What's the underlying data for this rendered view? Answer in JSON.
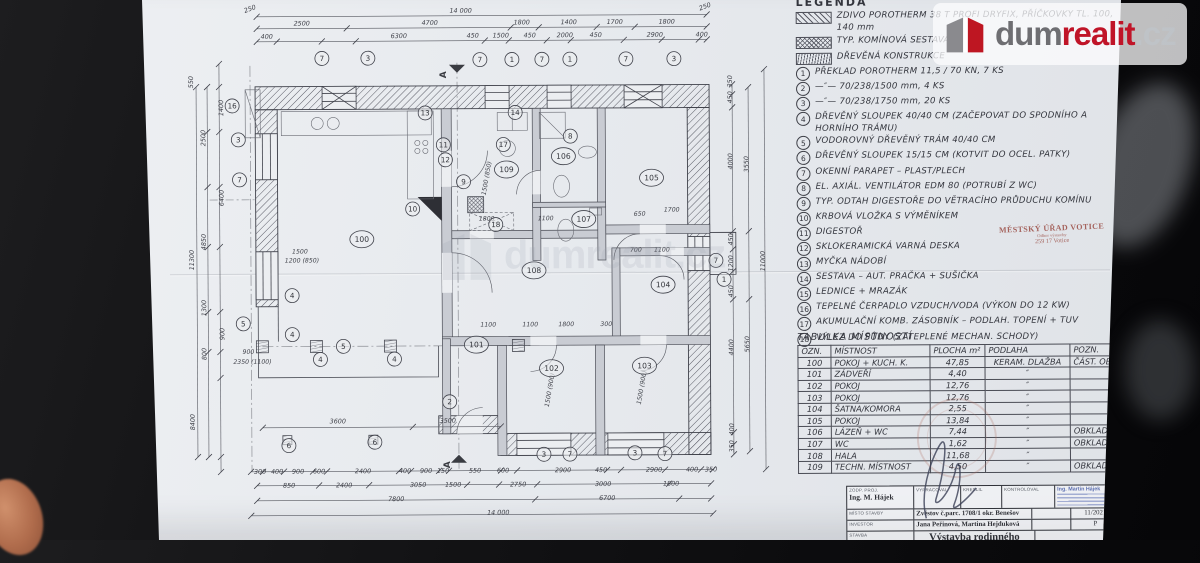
{
  "logo": {
    "dum": "dum",
    "realit": "realit",
    "cz": ".cz"
  },
  "watermark": {
    "dum": "dum",
    "realit": "realit",
    "cz": ".cz"
  },
  "legend": {
    "title": "LEGENDA",
    "swatches": [
      {
        "style": "brick",
        "label": "ZDIVO POROTHERM 38 T PROFI DRYFIX, PŘÍČKOVKY TL. 100, 140 mm"
      },
      {
        "style": "chimney",
        "label": "TYP. KOMÍNOVÁ SESTAVA"
      },
      {
        "style": "wood",
        "label": "DŘEVĚNÁ KONSTRUKCE"
      }
    ],
    "items": [
      {
        "num": "1",
        "text": "PŘEKLAD POROTHERM 11,5 / 70 KN, 7 KS"
      },
      {
        "num": "2",
        "text": "—″— 70/238/1500 mm, 4 KS"
      },
      {
        "num": "3",
        "text": "—″— 70/238/1750 mm, 20 KS"
      },
      {
        "num": "4",
        "text": "DŘEVĚNÝ SLOUPEK 40/40 CM (ZAČEPOVAT DO SPODNÍHO A HORNÍHO TRÁMU)"
      },
      {
        "num": "5",
        "text": "VODOROVNÝ DŘEVĚNÝ TRÁM 40/40 CM"
      },
      {
        "num": "6",
        "text": "DŘEVĚNÝ SLOUPEK 15/15 CM (KOTVIT DO OCEL. PATKY)"
      },
      {
        "num": "7",
        "text": "OKENNÍ PARAPET – PLAST/PLECH"
      },
      {
        "num": "8",
        "text": "EL. AXIÁL. VENTILÁTOR EDM 80 (POTRUBÍ Z WC)"
      },
      {
        "num": "9",
        "text": "TYP. ODTAH DIGESTOŘE DO VĚTRACÍHO PRŮDUCHU KOMÍNU"
      },
      {
        "num": "10",
        "text": "KRBOVÁ VLOŽKA S VÝMĚNÍKEM"
      },
      {
        "num": "11",
        "text": "DIGESTOŘ"
      },
      {
        "num": "12",
        "text": "SKLOKERAMICKÁ VARNÁ DESKA"
      },
      {
        "num": "13",
        "text": "MYČKA NÁDOBÍ"
      },
      {
        "num": "14",
        "text": "SESTAVA – AUT. PRAČKA + SUŠIČKA"
      },
      {
        "num": "15",
        "text": "LEDNICE + MRAZÁK"
      },
      {
        "num": "16",
        "text": "TEPELNÉ ČERPADLO VZDUCH/VODA (VÝKON DO 12 KW)"
      },
      {
        "num": "17",
        "text": "AKUMULAČNÍ KOMB. ZÁSOBNÍK – PODLAH. TOPENÍ + TUV"
      },
      {
        "num": "18",
        "text": "VÝLEZ DO PŮDY (ZATEPLENÉ MECHAN. SCHODY)"
      }
    ]
  },
  "votice_stamp": {
    "line1": "MĚSTSKÝ ÚŘAD VOTICE",
    "line2": "Odbor výstavby",
    "line3": "259 17 Votice"
  },
  "room_table": {
    "title": "TABULKA MÍSTNOSTÍ",
    "headers": [
      "OZN.",
      "MÍSTNOST",
      "PLOCHA m²",
      "PODLAHA",
      "POZN."
    ],
    "rows": [
      [
        "100",
        "POKOJ + KUCH. K.",
        "47,85",
        "KERAM. DLAŽBA",
        "ČÁST. OBKLAD"
      ],
      [
        "101",
        "ZÁDVEŘÍ",
        "4,40",
        "″",
        ""
      ],
      [
        "102",
        "POKOJ",
        "12,76",
        "″",
        ""
      ],
      [
        "103",
        "POKOJ",
        "12,76",
        "″",
        ""
      ],
      [
        "104",
        "ŠATNA/KOMORA",
        "2,55",
        "″",
        ""
      ],
      [
        "105",
        "POKOJ",
        "13,84",
        "″",
        ""
      ],
      [
        "106",
        "LÁZEŇ + WC",
        "7,44",
        "″",
        "OBKLAD"
      ],
      [
        "107",
        "WC",
        "1,62",
        "″",
        "OBKLAD"
      ],
      [
        "108",
        "HALA",
        "11,68",
        "″",
        ""
      ],
      [
        "109",
        "TECHN. MÍSTNOST",
        "4,50",
        "″",
        "OBKLAD"
      ]
    ]
  },
  "title_block": {
    "resp_label": "ZODP. PROJ.",
    "resp_value": "Ing. M. Hájek",
    "drafted_label": "VYPRACOVAL",
    "drawn_label": "KRESLIL",
    "checked_label": "KONTROLOVAL",
    "site_label": "MÍSTO STAVBY",
    "site_value": "Zvěstov č.parc. 1708/1 okr. Benešov",
    "investor_label": "INVESTOR",
    "investor_value": "Jana Peřinová, Martina Hejduková",
    "project_label": "STAVBA",
    "project_value": "Výstavba rodinného domku",
    "date_value": "11/2021",
    "stage_value": "P",
    "stamp_name": "Ing. Martin Hájek"
  },
  "plan": {
    "dims": [
      {
        "t": "14 000",
        "x": 462,
        "y": 12
      },
      {
        "t": "250",
        "x": 252,
        "y": 9,
        "r": -20
      },
      {
        "t": "250",
        "x": 707,
        "y": 9,
        "r": -20
      },
      {
        "t": "2500",
        "x": 303,
        "y": 24
      },
      {
        "t": "4700",
        "x": 431,
        "y": 24
      },
      {
        "t": "1800",
        "x": 523,
        "y": 24
      },
      {
        "t": "1400",
        "x": 570,
        "y": 24
      },
      {
        "t": "1700",
        "x": 616,
        "y": 24
      },
      {
        "t": "1800",
        "x": 668,
        "y": 24
      },
      {
        "t": "400",
        "x": 268,
        "y": 37
      },
      {
        "t": "6300",
        "x": 400,
        "y": 37
      },
      {
        "t": "450",
        "x": 474,
        "y": 37
      },
      {
        "t": "1500",
        "x": 502,
        "y": 37
      },
      {
        "t": "450",
        "x": 531,
        "y": 37
      },
      {
        "t": "2000",
        "x": 566,
        "y": 37
      },
      {
        "t": "450",
        "x": 597,
        "y": 37
      },
      {
        "t": "2900",
        "x": 656,
        "y": 37
      },
      {
        "t": "400",
        "x": 703,
        "y": 37
      },
      {
        "t": "300",
        "x": 259,
        "y": 472
      },
      {
        "t": "400",
        "x": 276,
        "y": 472
      },
      {
        "t": "900",
        "x": 297,
        "y": 472
      },
      {
        "t": "600",
        "x": 318,
        "y": 472
      },
      {
        "t": "2400",
        "x": 362,
        "y": 472
      },
      {
        "t": "400",
        "x": 404,
        "y": 472
      },
      {
        "t": "900",
        "x": 425,
        "y": 472
      },
      {
        "t": "150",
        "x": 442,
        "y": 472
      },
      {
        "t": "550",
        "x": 474,
        "y": 472
      },
      {
        "t": "600",
        "x": 502,
        "y": 472
      },
      {
        "t": "2900",
        "x": 562,
        "y": 472
      },
      {
        "t": "450",
        "x": 600,
        "y": 472
      },
      {
        "t": "2900",
        "x": 653,
        "y": 472
      },
      {
        "t": "400",
        "x": 691,
        "y": 472
      },
      {
        "t": "350",
        "x": 710,
        "y": 472
      },
      {
        "t": "850",
        "x": 288,
        "y": 486
      },
      {
        "t": "2400",
        "x": 343,
        "y": 486
      },
      {
        "t": "3050",
        "x": 417,
        "y": 486
      },
      {
        "t": "1500",
        "x": 452,
        "y": 486
      },
      {
        "t": "2750",
        "x": 517,
        "y": 486
      },
      {
        "t": "3000",
        "x": 602,
        "y": 486
      },
      {
        "t": "1800",
        "x": 670,
        "y": 486
      },
      {
        "t": "7800",
        "x": 395,
        "y": 500
      },
      {
        "t": "6700",
        "x": 606,
        "y": 500
      },
      {
        "t": "14 000",
        "x": 497,
        "y": 514
      },
      {
        "t": "3600",
        "x": 337,
        "y": 422
      },
      {
        "t": "3500",
        "x": 447,
        "y": 422
      },
      {
        "t": "550",
        "x": 194,
        "y": 80,
        "r": -90
      },
      {
        "t": "1400",
        "x": 224,
        "y": 106,
        "r": -90
      },
      {
        "t": "2500",
        "x": 206,
        "y": 136,
        "r": -90
      },
      {
        "t": "6400",
        "x": 224,
        "y": 196,
        "r": -90
      },
      {
        "t": "4850",
        "x": 206,
        "y": 240,
        "r": -90
      },
      {
        "t": "11300",
        "x": 194,
        "y": 258,
        "r": -90
      },
      {
        "t": "1300",
        "x": 206,
        "y": 306,
        "r": -90
      },
      {
        "t": "900",
        "x": 224,
        "y": 332,
        "r": -90
      },
      {
        "t": "800",
        "x": 206,
        "y": 352,
        "r": -90
      },
      {
        "t": "8400",
        "x": 194,
        "y": 420,
        "r": -90
      },
      {
        "t": "350",
        "x": 733,
        "y": 82,
        "r": -90
      },
      {
        "t": "450",
        "x": 733,
        "y": 98,
        "r": -90
      },
      {
        "t": "4000",
        "x": 733,
        "y": 162,
        "r": -90
      },
      {
        "t": "3550",
        "x": 749,
        "y": 165,
        "r": -90
      },
      {
        "t": "450",
        "x": 733,
        "y": 240,
        "r": -90
      },
      {
        "t": "1200",
        "x": 733,
        "y": 264,
        "r": -90
      },
      {
        "t": "450",
        "x": 733,
        "y": 292,
        "r": -90
      },
      {
        "t": "4400",
        "x": 733,
        "y": 348,
        "r": -90
      },
      {
        "t": "5650",
        "x": 749,
        "y": 345,
        "r": -90
      },
      {
        "t": "400",
        "x": 733,
        "y": 430,
        "r": -90
      },
      {
        "t": "350",
        "x": 733,
        "y": 447,
        "r": -90
      },
      {
        "t": "11000",
        "x": 765,
        "y": 262,
        "r": -90
      }
    ],
    "notes": [
      {
        "t": "1500",
        "x": 300,
        "y": 252
      },
      {
        "t": "1200 (850)",
        "x": 302,
        "y": 261
      },
      {
        "t": "2350 (1100)",
        "x": 252,
        "y": 362
      },
      {
        "t": "900",
        "x": 248,
        "y": 352
      },
      {
        "t": "1800",
        "x": 487,
        "y": 220
      },
      {
        "t": "1100",
        "x": 546,
        "y": 220
      },
      {
        "t": "650",
        "x": 640,
        "y": 216
      },
      {
        "t": "1700",
        "x": 672,
        "y": 212
      },
      {
        "t": "700",
        "x": 636,
        "y": 252
      },
      {
        "t": "1100",
        "x": 662,
        "y": 252
      },
      {
        "t": "1100",
        "x": 488,
        "y": 326
      },
      {
        "t": "1100",
        "x": 530,
        "y": 326
      },
      {
        "t": "1800",
        "x": 566,
        "y": 326
      },
      {
        "t": "300",
        "x": 606,
        "y": 326
      },
      {
        "t": "1500 (900)",
        "x": 551,
        "y": 390,
        "r": -80
      },
      {
        "t": "1500 (900)",
        "x": 643,
        "y": 388,
        "r": -80
      },
      {
        "t": "1500 (850)",
        "x": 489,
        "y": 178,
        "r": -80
      }
    ],
    "bubbles": [
      {
        "n": "100",
        "x": 362,
        "y": 238
      },
      {
        "n": "101",
        "x": 476,
        "y": 344
      },
      {
        "n": "102",
        "x": 551,
        "y": 368
      },
      {
        "n": "103",
        "x": 644,
        "y": 366
      },
      {
        "n": "104",
        "x": 663,
        "y": 285
      },
      {
        "n": "105",
        "x": 652,
        "y": 178
      },
      {
        "n": "106",
        "x": 564,
        "y": 156
      },
      {
        "n": "107",
        "x": 584,
        "y": 219
      },
      {
        "n": "108",
        "x": 534,
        "y": 270
      },
      {
        "n": "109",
        "x": 507,
        "y": 169
      }
    ],
    "refs": [
      {
        "n": "7",
        "x": 323,
        "y": 57
      },
      {
        "n": "3",
        "x": 369,
        "y": 57
      },
      {
        "n": "7",
        "x": 481,
        "y": 59
      },
      {
        "n": "1",
        "x": 513,
        "y": 59
      },
      {
        "n": "7",
        "x": 543,
        "y": 59
      },
      {
        "n": "1",
        "x": 571,
        "y": 59
      },
      {
        "n": "7",
        "x": 627,
        "y": 59
      },
      {
        "n": "3",
        "x": 675,
        "y": 59
      },
      {
        "n": "16",
        "x": 233,
        "y": 104
      },
      {
        "n": "3",
        "x": 239,
        "y": 138
      },
      {
        "n": "7",
        "x": 240,
        "y": 178
      },
      {
        "n": "4",
        "x": 292,
        "y": 294
      },
      {
        "n": "5",
        "x": 243,
        "y": 322
      },
      {
        "n": "4",
        "x": 292,
        "y": 333
      },
      {
        "n": "4",
        "x": 320,
        "y": 358
      },
      {
        "n": "5",
        "x": 343,
        "y": 345
      },
      {
        "n": "4",
        "x": 394,
        "y": 358
      },
      {
        "n": "2",
        "x": 449,
        "y": 401
      },
      {
        "n": "6",
        "x": 288,
        "y": 444
      },
      {
        "n": "6",
        "x": 374,
        "y": 441
      },
      {
        "n": "13",
        "x": 426,
        "y": 112
      },
      {
        "n": "14",
        "x": 516,
        "y": 112
      },
      {
        "n": "11",
        "x": 444,
        "y": 144
      },
      {
        "n": "12",
        "x": 446,
        "y": 159
      },
      {
        "n": "17",
        "x": 504,
        "y": 144
      },
      {
        "n": "9",
        "x": 464,
        "y": 181
      },
      {
        "n": "8",
        "x": 571,
        "y": 136
      },
      {
        "n": "10",
        "x": 413,
        "y": 208
      },
      {
        "n": "18",
        "x": 496,
        "y": 224
      },
      {
        "n": "7",
        "x": 716,
        "y": 261
      },
      {
        "n": "1",
        "x": 724,
        "y": 280
      },
      {
        "n": "3",
        "x": 543,
        "y": 454
      },
      {
        "n": "7",
        "x": 569,
        "y": 454
      },
      {
        "n": "3",
        "x": 634,
        "y": 453
      },
      {
        "n": "7",
        "x": 664,
        "y": 454
      }
    ],
    "section_marks": [
      {
        "t": "A",
        "x": 447,
        "y": 74
      },
      {
        "t": "A",
        "x": 449,
        "y": 464
      }
    ]
  }
}
